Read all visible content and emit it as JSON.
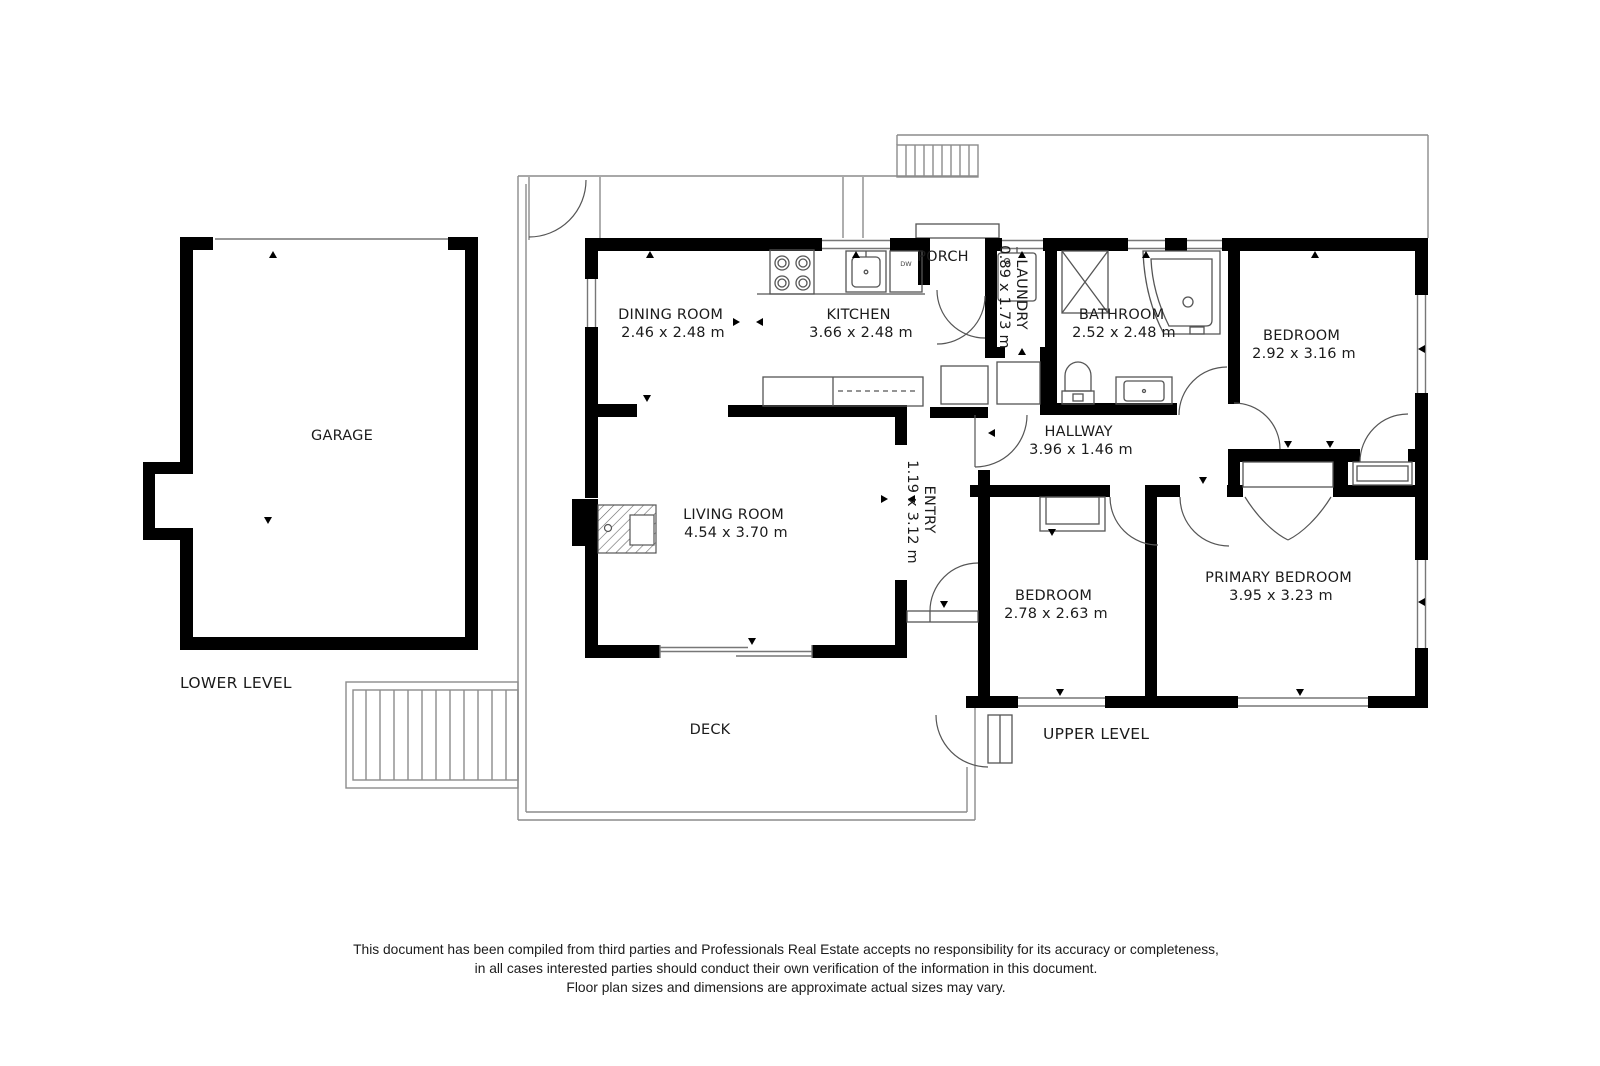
{
  "floor_plan": {
    "level_labels": {
      "lower": "LOWER LEVEL",
      "upper": "UPPER LEVEL"
    },
    "rooms": [
      {
        "name": "GARAGE",
        "dims": ""
      },
      {
        "name": "DINING ROOM",
        "dims": "2.46 x 2.48 m"
      },
      {
        "name": "KITCHEN",
        "dims": "3.66 x 2.48 m"
      },
      {
        "name": "PORCH",
        "dims": ""
      },
      {
        "name": "LAUNDRY",
        "dims": "0.89 x 1.73 m"
      },
      {
        "name": "BATHROOM",
        "dims": "2.52 x 2.48 m"
      },
      {
        "name": "BEDROOM",
        "dims": "2.92 x 3.16 m"
      },
      {
        "name": "HALLWAY",
        "dims": "3.96 x 1.46 m"
      },
      {
        "name": "ENTRY",
        "dims": "1.19 x 3.12 m"
      },
      {
        "name": "LIVING ROOM",
        "dims": "4.54 x 3.70 m"
      },
      {
        "name": "BEDROOM",
        "dims": "2.78 x 2.63 m"
      },
      {
        "name": "PRIMARY BEDROOM",
        "dims": "3.95 x 3.23 m"
      },
      {
        "name": "DECK",
        "dims": ""
      }
    ],
    "appliances": {
      "dishwasher": "DW"
    },
    "disclaimer": {
      "line1": "This document has been compiled from third parties and Professionals Real Estate accepts no responsibility for its accuracy or completeness,",
      "line2": "in all cases interested parties should conduct their own verification of the information in this document.",
      "line3": "Floor plan sizes and dimensions are approximate actual sizes may vary."
    },
    "colors": {
      "wall": "#000000",
      "background": "#ffffff",
      "fixture_line": "#555555",
      "outline": "#8c8c8c",
      "text": "#1b1b1b"
    }
  }
}
